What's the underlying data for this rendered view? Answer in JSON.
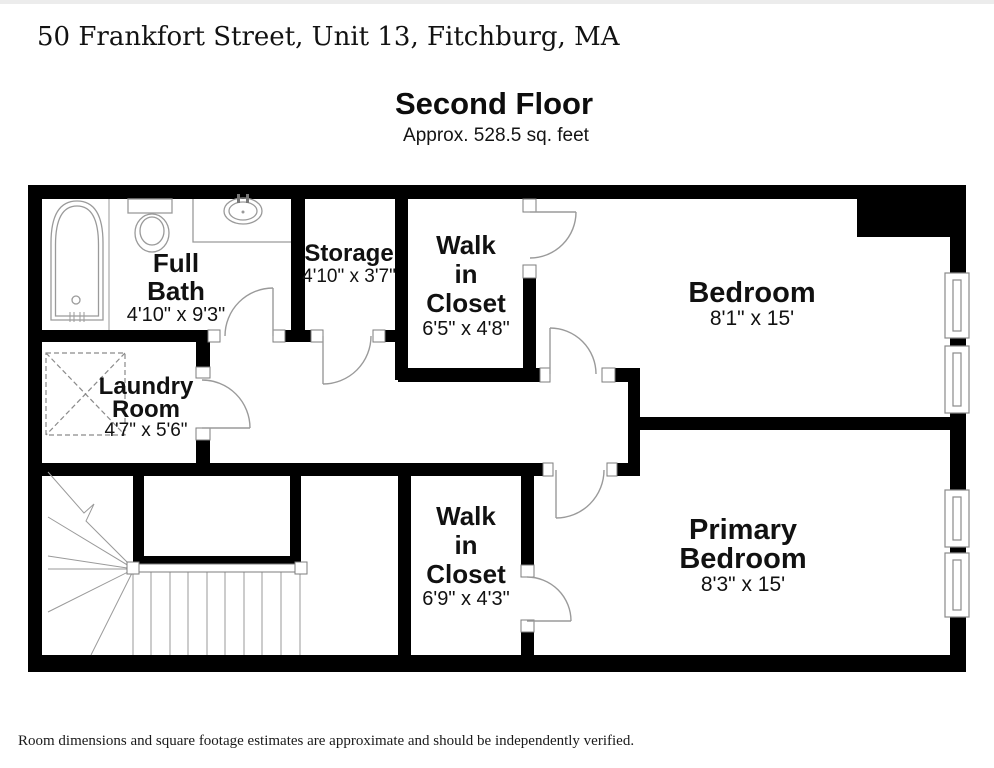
{
  "header": {
    "address": "50 Frankfort Street, Unit 13, Fitchburg, MA",
    "floor_name": "Second Floor",
    "floor_area": "Approx. 528.5 sq. feet"
  },
  "rooms": {
    "full_bath": {
      "line1": "Full",
      "line2": "Bath",
      "dims": "4'10\" x 9'3\""
    },
    "storage": {
      "label": "Storage",
      "dims": "4'10\" x 3'7\""
    },
    "walk_in_closet_upper": {
      "line1": "Walk",
      "line2": "in",
      "line3": "Closet",
      "dims": "6'5\" x 4'8\""
    },
    "bedroom": {
      "label": "Bedroom",
      "dims": "8'1\" x 15'"
    },
    "laundry_room": {
      "line1": "Laundry",
      "line2": "Room",
      "dims": "4'7\" x 5'6\""
    },
    "walk_in_closet_lower": {
      "line1": "Walk",
      "line2": "in",
      "line3": "Closet",
      "dims": "6'9\" x 4'3\""
    },
    "primary_bedroom": {
      "line1": "Primary",
      "line2": "Bedroom",
      "dims": "8'3\" x 15'"
    }
  },
  "footer": {
    "disclaimer": "Room dimensions and square footage estimates are approximate and should be independently verified."
  },
  "colors": {
    "wall": "#000000",
    "fixture_line": "#9a9a9a",
    "text": "#111111",
    "background": "#ffffff"
  }
}
